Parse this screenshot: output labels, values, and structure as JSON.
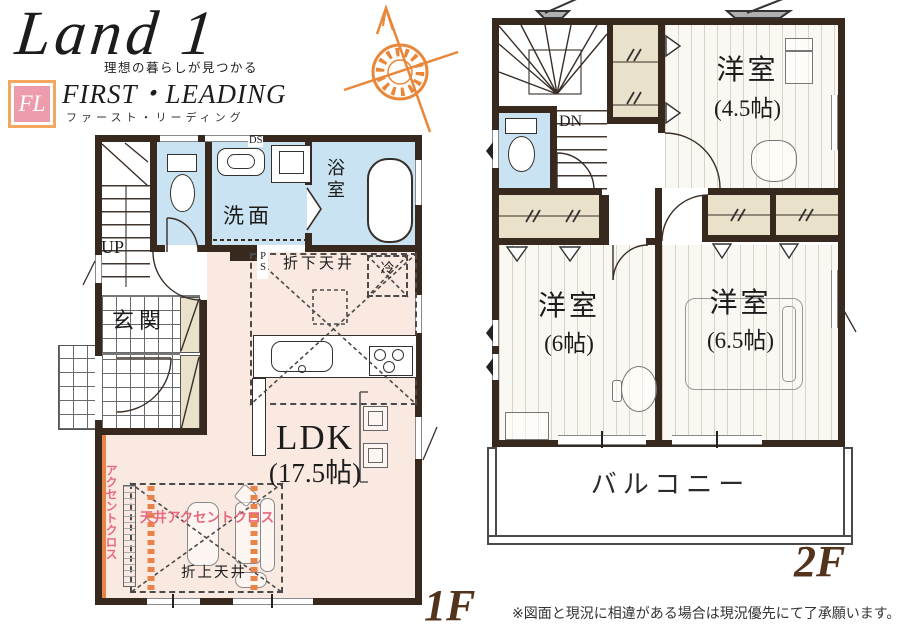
{
  "header": {
    "brand_script": "Land 1",
    "tagline": "理想の暮らしが見つかる",
    "monogram": "FL",
    "brand_name": "FIRST・LEADING",
    "brand_kana": "ファースト・リーディング"
  },
  "floor1": {
    "label": "1F",
    "up": "UP",
    "ds": "DS",
    "ps": "PS",
    "entrance": "玄関",
    "washroom": "洗面",
    "bathroom": "浴室",
    "fridge": "冷",
    "dropped_ceiling": "折下天井",
    "ldk_name": "LDK",
    "ldk_size": "(17.5帖)",
    "ceiling_accent": "天井アクセントクロス",
    "raised_ceiling": "折上天井",
    "accent_cloth": "アクセントクロス"
  },
  "floor2": {
    "label": "2F",
    "dn": "DN",
    "room_a": {
      "name": "洋室",
      "size": "(4.5帖)"
    },
    "room_b": {
      "name": "洋室",
      "size": "(6帖)"
    },
    "room_c": {
      "name": "洋室",
      "size": "(6.5帖)"
    },
    "balcony": "バルコニー"
  },
  "footer": {
    "disclaimer": "※図面と現況に相違がある場合は現況優先にて了承願います。"
  },
  "colors": {
    "wall": "#38291f",
    "wet_room": "#c9e3f2",
    "ldk_floor": "#f9e9e0",
    "closet": "#e9e1ca",
    "accent_orange": "#e8834a",
    "accent_pink": "#e8697f",
    "floor_label": "#54331c",
    "compass": "#e8873a"
  }
}
